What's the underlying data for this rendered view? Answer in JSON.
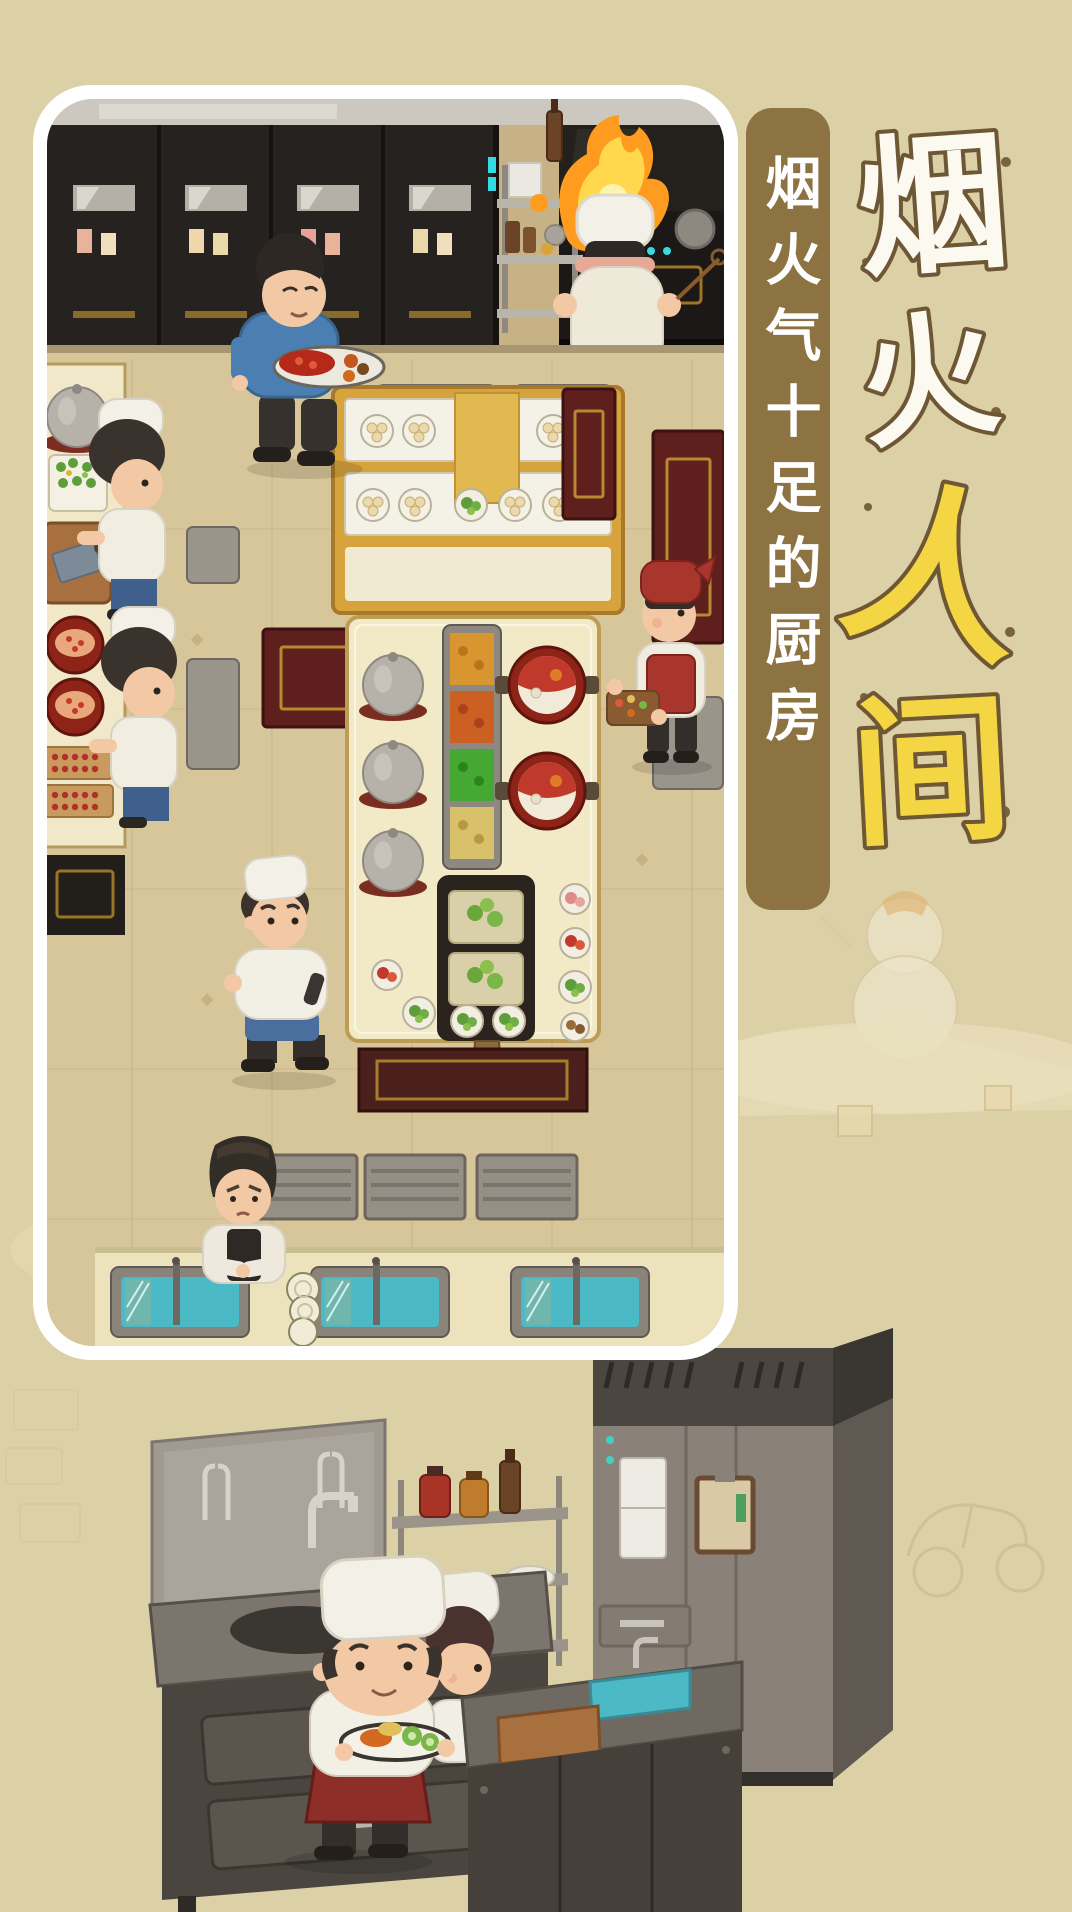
{
  "title": {
    "name": "烟火人间",
    "chars": [
      {
        "text": "烟",
        "color": "#fcf9f0"
      },
      {
        "text": "火",
        "color": "#fcf9f0"
      },
      {
        "text": "人",
        "color": "#f4d544"
      },
      {
        "text": "间",
        "color": "#f4d544"
      }
    ]
  },
  "banner": {
    "text": "烟火气十足的厨房"
  },
  "colors": {
    "page_bg": "#dcd0a6",
    "frame_border": "#ffffff",
    "banner_bg": "#8d7342",
    "banner_text": "#ffffff",
    "title_outline": "#6e5734",
    "floor_tan": "#d8c69b",
    "cabinet_dark": "#262220",
    "gold_trim": "#a8832f",
    "counter_cream": "#f0e8c8",
    "hotpot_red": "#8e2418",
    "water_teal": "#4cb9c6",
    "flame_orange": "#ff9c20",
    "flame_yellow": "#ffd84e",
    "metal_gray": "#8b8279",
    "apron_red": "#a8362c",
    "shirt_blue": "#4b7fb1"
  }
}
